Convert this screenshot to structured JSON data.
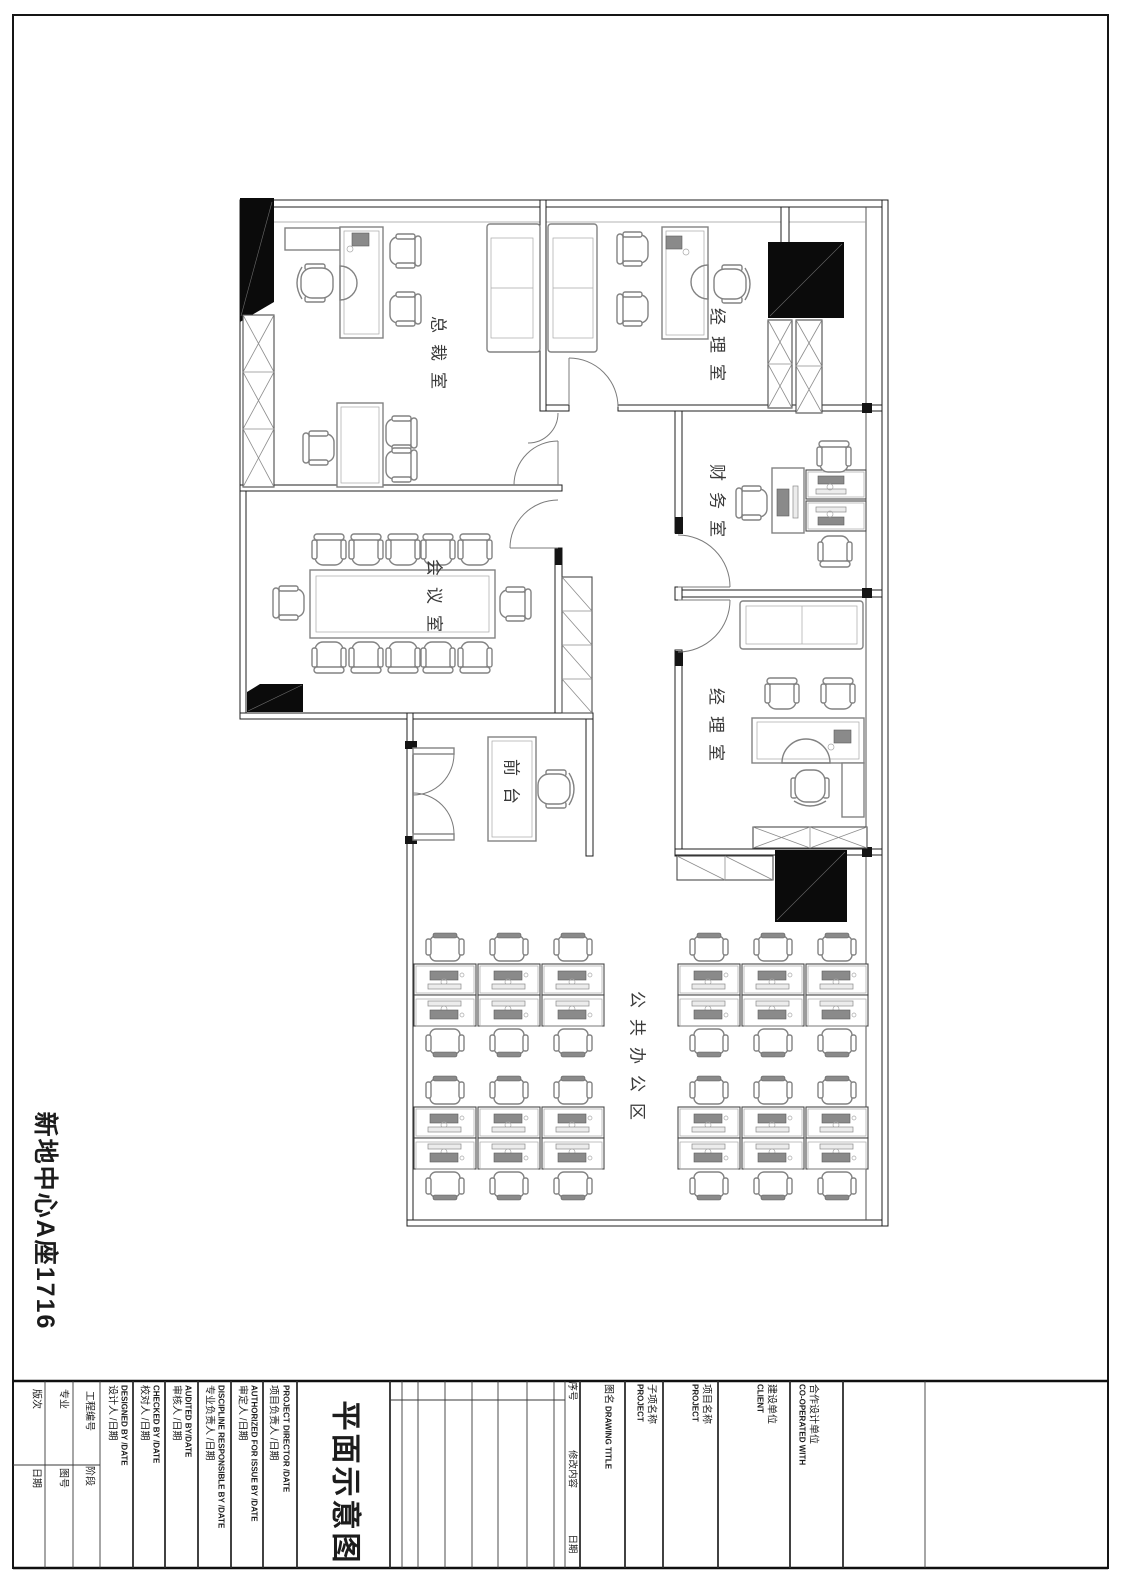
{
  "sheet": {
    "side_label": "新地中心A座1716",
    "drawing_title": "平面示意图"
  },
  "rooms": {
    "president": "总裁室",
    "manager_top": "经理室",
    "finance": "财务室",
    "meeting": "会议室",
    "manager_right": "经理室",
    "reception": "前台",
    "open_office": "公共办公区"
  },
  "titleblock": {
    "version_label": "版次",
    "date_label": "日期",
    "discipline_label": "专业",
    "sheet_no_label": "图号",
    "project_no_label": "工程编号",
    "stage_label": "阶段",
    "designed_cn": "设计人 /日期",
    "designed_en": "DESIGNED BY /DATE",
    "checked_cn": "校对人 /日期",
    "checked_en": "CHECKED BY /DATE",
    "audited_cn": "审核人 /日期",
    "audited_en": "AUDITED BY/DATE",
    "discipline_resp_cn": "专业负责人 /日期",
    "discipline_resp_en": "DISCIPLINE RESPONSIBLE BY /DATE",
    "authorized_cn": "审定人 /日期",
    "authorized_en": "AUTHORIZED FOR ISSUE BY /DATE",
    "director_cn": "项目负责人 /日期",
    "director_en": "PROJECT DIRECTOR /DATE",
    "rev_no": "序号",
    "rev_content": "修改内容",
    "rev_date": "日期",
    "drawing_name_cn": "图名",
    "drawing_name_en": "DRAWING TITLE",
    "subproject_cn": "子项名称",
    "subproject_en": "PROJECT",
    "project_cn": "项目名称",
    "project_en": "PROJECT",
    "client_cn": "建设单位",
    "client_en": "CLIENT",
    "cooperated_cn": "合作设计单位",
    "cooperated_en": "CO-OPERATED WITH"
  }
}
